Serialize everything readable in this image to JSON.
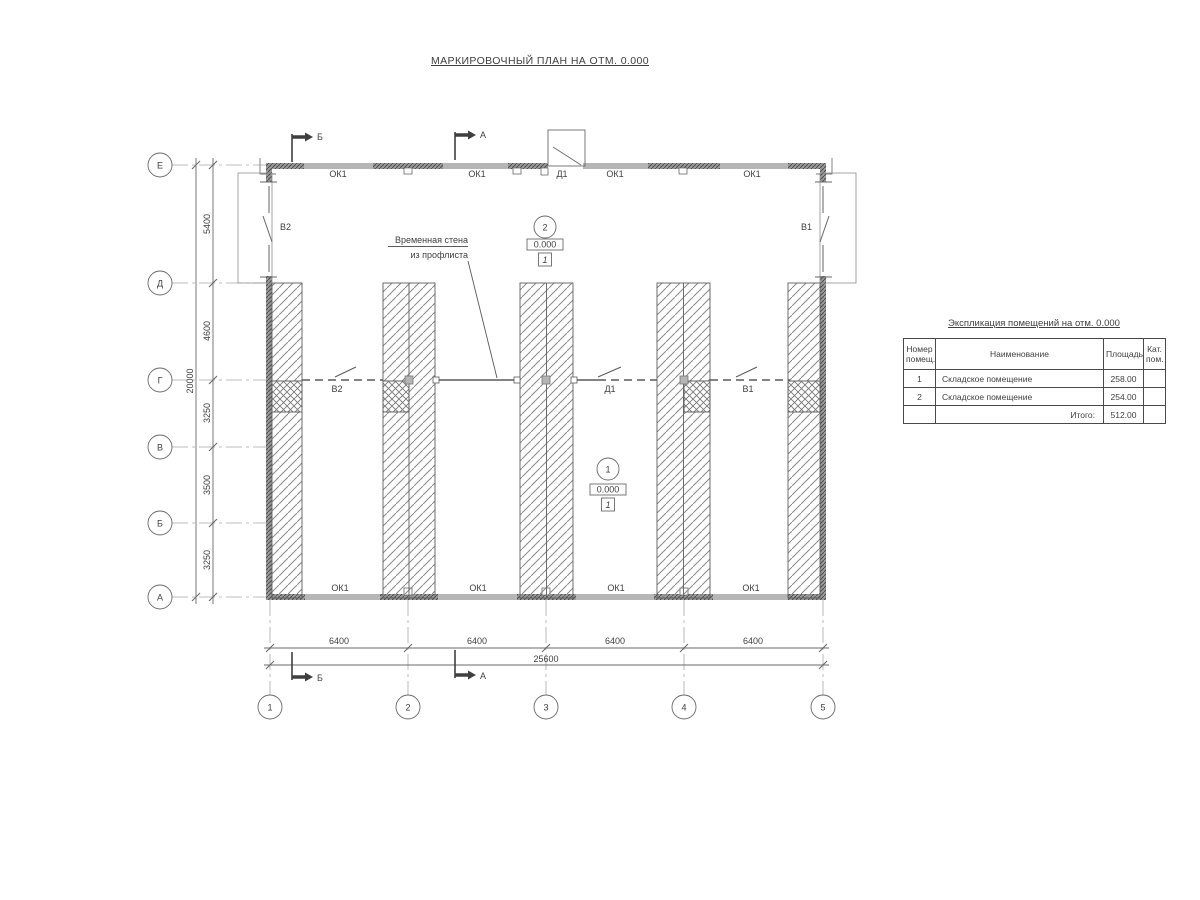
{
  "title": "МАРКИРОВОЧНЫЙ ПЛАН НА ОТМ. 0.000",
  "plan": {
    "axes_bottom": [
      "1",
      "2",
      "3",
      "4",
      "5"
    ],
    "axes_left": [
      "Е",
      "Д",
      "Г",
      "В",
      "Б",
      "А"
    ],
    "dims_left": [
      "5400",
      "4600",
      "3250",
      "3500",
      "3250"
    ],
    "dim_left_total": "20000",
    "dims_bottom": [
      "6400",
      "6400",
      "6400",
      "6400"
    ],
    "dim_bottom_total": "25600",
    "window_label": "ОК1",
    "door_label": "Д1",
    "gate_v1": "В1",
    "gate_v2": "В2",
    "section_a": "А",
    "section_b": "Б",
    "annotation": {
      "line1": "Временная стена",
      "line2": "из профлиста"
    },
    "rooms": [
      {
        "number": "1",
        "elevation": "0.000",
        "floor_mark": "1"
      },
      {
        "number": "2",
        "elevation": "0.000",
        "floor_mark": "1"
      }
    ]
  },
  "table": {
    "title": "Экспликация помещений на отм. 0.000",
    "headers": {
      "num": "Номер помещ.",
      "name": "Наименование",
      "area": "Площадь",
      "cat": "Кат. пом."
    },
    "rows": [
      {
        "num": "1",
        "name": "Складское помещение",
        "area": "258.00",
        "cat": ""
      },
      {
        "num": "2",
        "name": "Складское помещение",
        "area": "254.00",
        "cat": ""
      }
    ],
    "total_label": "Итого:",
    "total_value": "512.00"
  },
  "colors": {
    "line": "#555555",
    "wall_fill": "#b6b6b6",
    "hatch": "#8a8a8a",
    "text": "#3f3f3f"
  }
}
